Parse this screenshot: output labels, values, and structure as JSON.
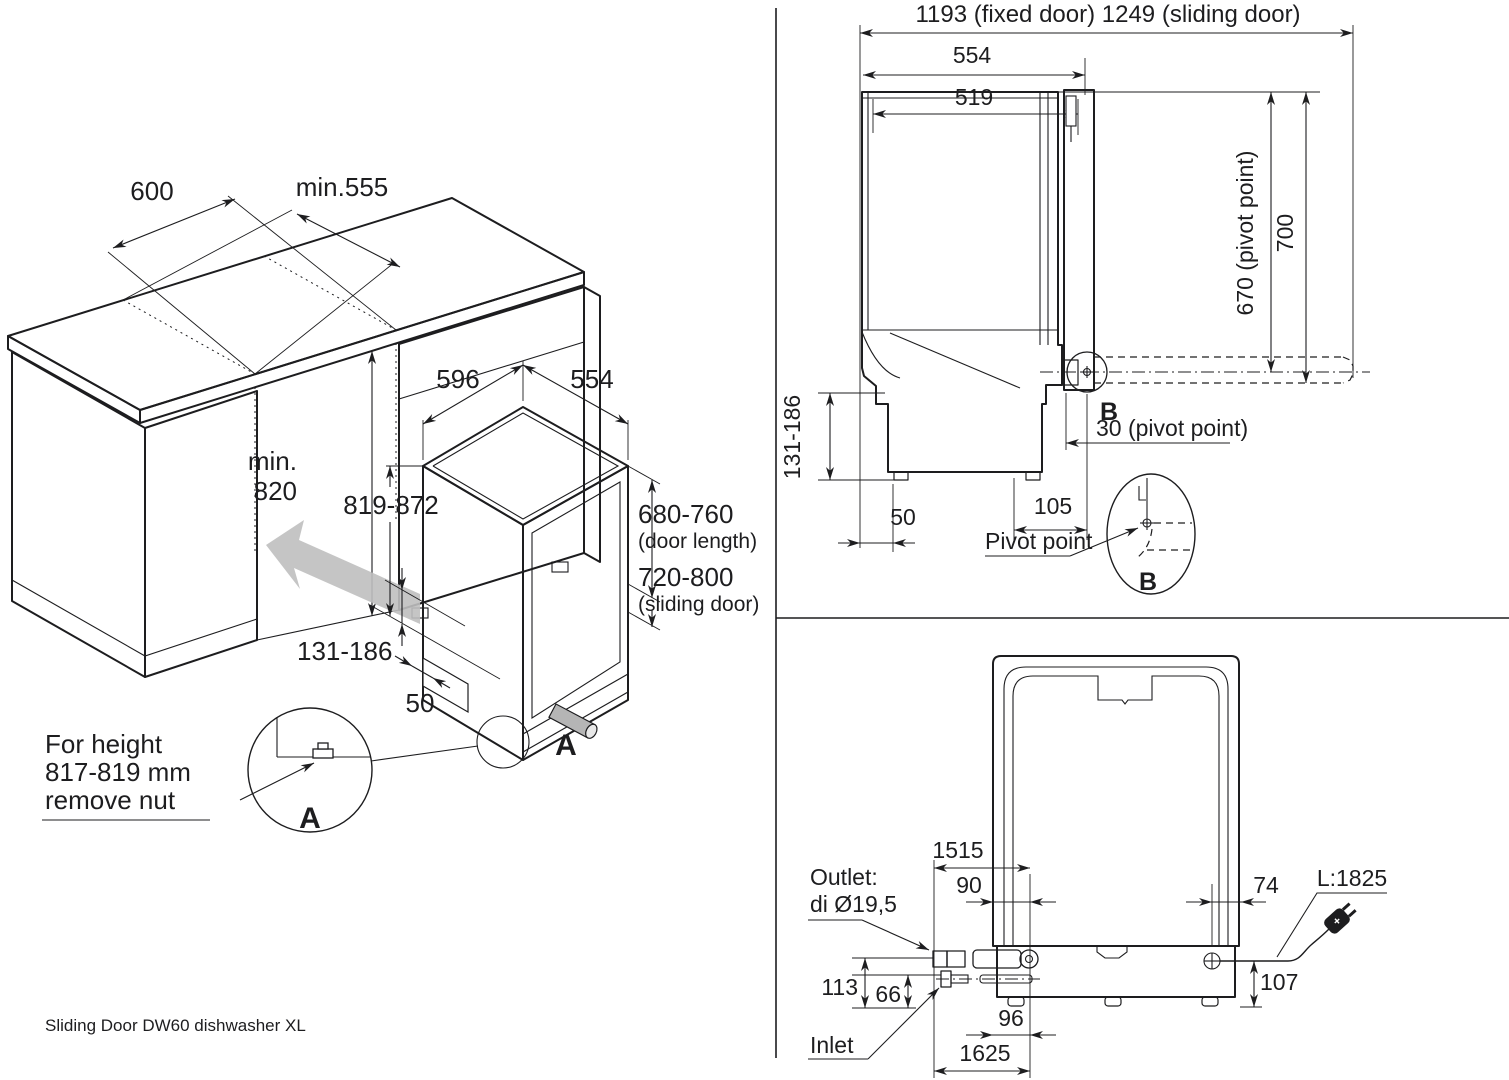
{
  "colors": {
    "body_gray": "#a9a9a9",
    "top_gray": "#b9b9b9",
    "door_gray": "#9d9d9d",
    "kick_gray": "#d2d2d2",
    "arrow_gray": "#bfbfbf",
    "line": "#1d1d1f"
  },
  "footer": {
    "caption": "Sliding Door DW60 dishwasher XL"
  },
  "iso": {
    "dims": {
      "counter_width": "600",
      "counter_depth": "min.555",
      "niche_height_1": "min.",
      "niche_height_2": "820",
      "dw_width": "596",
      "dw_depth": "554",
      "dw_height": "819-872",
      "door_length": "680-760",
      "door_length_note": "(door length)",
      "sliding_door": "720-800",
      "sliding_door_note": "(sliding door)",
      "plinth_height": "131-186",
      "plinth_depth": "50"
    },
    "detail_ref": "A",
    "detail_label": "A",
    "note_1": "For height",
    "note_2": "817-819 mm",
    "note_3": "remove nut"
  },
  "side": {
    "dims": {
      "total_depth": "1193 (fixed door) 1249 (sliding door)",
      "depth_outer": "554",
      "depth_inner": "519",
      "pivot_height": "670 (pivot point)",
      "top_height": "700",
      "foot_range": "131-186",
      "back_gap": "50",
      "pivot_x": "105",
      "pivot_note": "30 (pivot point)"
    },
    "detail_ref": "B",
    "detail_label": "B",
    "pivot_label": "Pivot point"
  },
  "back": {
    "dims": {
      "outlet_hose_len": "1515",
      "outlet_pos": "90",
      "cord_pos": "74",
      "cord_len": "L:1825",
      "outlet_height": "113",
      "inlet_height": "66",
      "cord_height": "107",
      "inlet_pos": "96",
      "inlet_hose_len": "1625"
    },
    "outlet_1": "Outlet:",
    "outlet_2": "di Ø19,5",
    "inlet": "Inlet"
  }
}
